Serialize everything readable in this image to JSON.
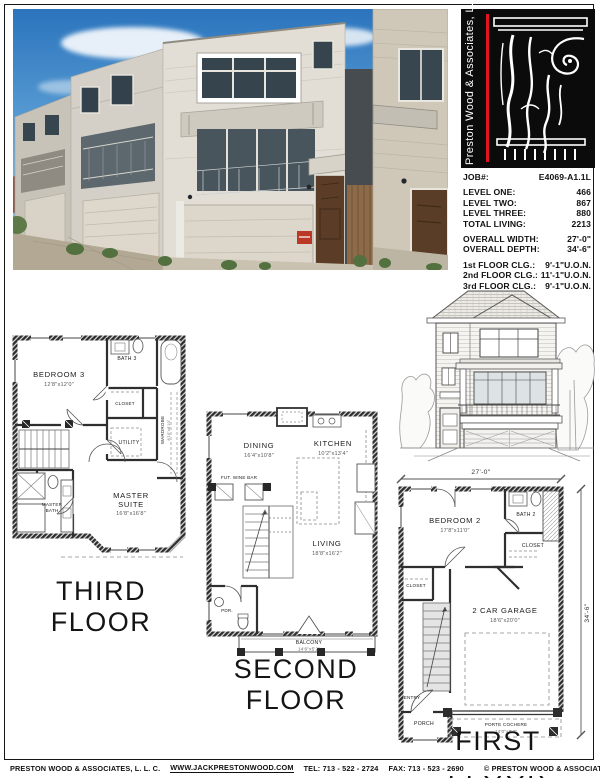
{
  "logo": {
    "vertical_text": "Preston Wood & Associates, L.L.C.",
    "accent_red": "#e0131f"
  },
  "job": {
    "job_label": "JOB#:",
    "job_number": "E4069-A1.1L",
    "levels": [
      {
        "label": "LEVEL ONE:",
        "value": "466"
      },
      {
        "label": "LEVEL TWO:",
        "value": "867"
      },
      {
        "label": "LEVEL THREE:",
        "value": "880"
      },
      {
        "label": "TOTAL LIVING:",
        "value": "2213"
      }
    ],
    "overall": [
      {
        "label": "OVERALL WIDTH:",
        "value": "27'-0\""
      },
      {
        "label": "OVERALL DEPTH:",
        "value": "34'-6\""
      }
    ],
    "ceilings": [
      {
        "label": "1st FLOOR CLG.:",
        "value": "9'-1\"U.O.N."
      },
      {
        "label": "2nd FLOOR CLG.:",
        "value": "11'-1\"U.O.N."
      },
      {
        "label": "3rd FLOOR CLG.:",
        "value": "9'-1\"U.O.N."
      }
    ]
  },
  "third_floor": {
    "title": "THIRD FLOOR",
    "bedroom3_name": "BEDROOM 3",
    "bedroom3_dims": "12'8\"x12'0\"",
    "bath3": "BATH 3",
    "closet": "CLOSET",
    "wardrobe_name": "WARDROBE",
    "wardrobe_dims": "8'10\"x6'10\"",
    "utility": "UTILITY",
    "master_l1": "MASTER",
    "master_l2": "SUITE",
    "master_dims": "16'8\"x16'8\"",
    "masterbath_l1": "MASTER",
    "masterbath_l2": "BATH"
  },
  "second_floor": {
    "title": "SECOND FLOOR",
    "dining_name": "DINING",
    "dining_dims": "16'4\"x10'8\"",
    "kitchen_name": "KITCHEN",
    "kitchen_dims": "10'2\"x13'4\"",
    "winebar": "FUT. WINE BAR",
    "living_name": "LIVING",
    "living_dims": "18'8\"x16'2\"",
    "pdr": "PDR.",
    "balcony_name": "BALCONY",
    "balcony_dims": "14'6\"x5'2\""
  },
  "first_floor": {
    "title": "FIRST FLOOR",
    "width_dim": "27'-0\"",
    "depth_dim": "34'-6\"",
    "bedroom2_name": "BEDROOM 2",
    "bedroom2_dims": "17'8\"x11'0\"",
    "bath2": "BATH 2",
    "closet_right": "CLOSET",
    "closet_left": "CLOSET",
    "entry": "ENTRY",
    "porch": "PORCH",
    "garage_name": "2 CAR GARAGE",
    "garage_dims": "18'6\"x20'0\"",
    "porte_name": "PORTE COCHERE",
    "porte_dims": "14'0\"x8'2\""
  },
  "footer": {
    "company": "PRESTON WOOD & ASSOCIATES, L. L. C.",
    "website": "WWW.JACKPRESTONWOOD.COM",
    "tel": "TEL:  713 - 522 - 2724",
    "fax": "FAX:  713 - 523 - 2690",
    "copyright": "© PRESTON WOOD & ASSOCIATES, L. L. C.  COPYRIGHT"
  }
}
